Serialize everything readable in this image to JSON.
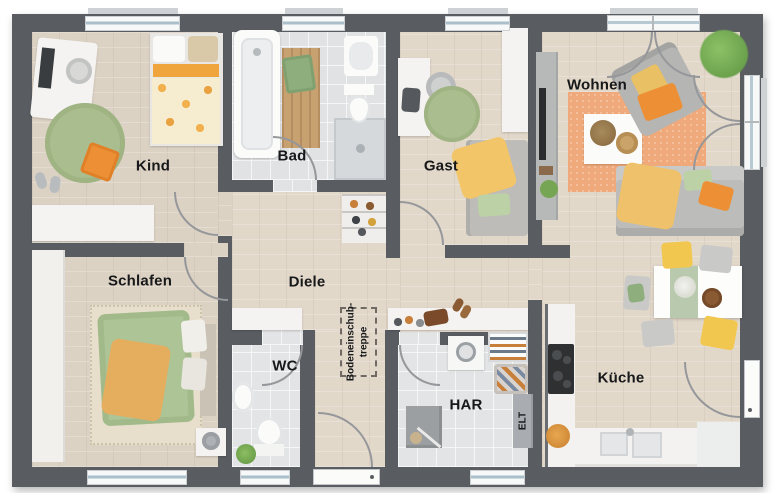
{
  "plan": {
    "rooms": {
      "kind": {
        "label": "Kind"
      },
      "bad": {
        "label": "Bad"
      },
      "gast": {
        "label": "Gast"
      },
      "wohnen": {
        "label": "Wohnen"
      },
      "schlafen": {
        "label": "Schlafen"
      },
      "diele": {
        "label": "Diele"
      },
      "wc": {
        "label": "WC"
      },
      "har": {
        "label": "HAR"
      },
      "kueche": {
        "label": "Küche"
      },
      "elt": {
        "label": "ELT"
      },
      "attic_hatch": {
        "label_line1": "Bodeneinschub-",
        "label_line2": "treppe"
      }
    },
    "palette": {
      "wall": "#595d62",
      "wood_floor": "#dcd2c4",
      "tile_floor": "#e0e2e4",
      "accent_orange": "#ec8f35",
      "accent_yellow": "#f2c74f",
      "accent_green": "#a9bd8e",
      "furniture_white": "#f4f3f1",
      "furniture_gray": "#bcbcba"
    }
  }
}
